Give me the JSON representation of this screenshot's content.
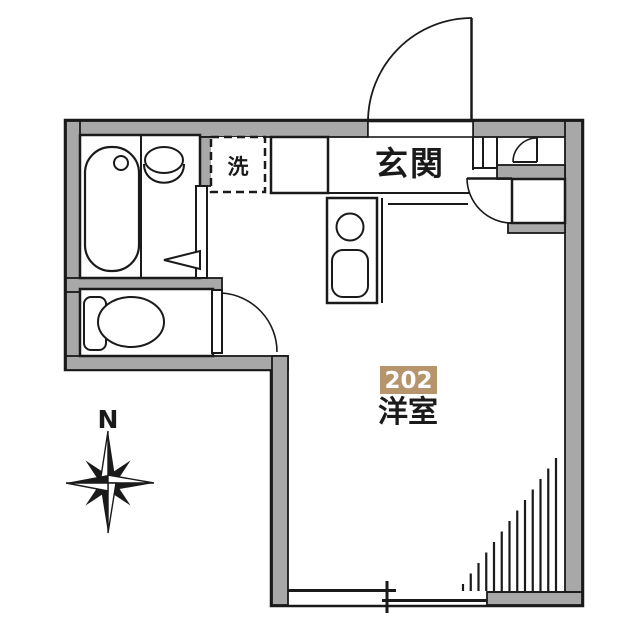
{
  "plan": {
    "labels": {
      "entrance": "玄関",
      "laundry": "洗",
      "room_number": "202",
      "room_name": "洋室",
      "compass_north": "N"
    },
    "colors": {
      "wall_gray": "#a8a8a8",
      "line_black": "#1a1a1a",
      "badge_background": "#b6946c",
      "badge_text": "#ffffff",
      "floor_white": "#ffffff"
    },
    "fixtures": [
      "bathtub",
      "bath-faucet",
      "washbasin",
      "toilet",
      "toilet-tank",
      "washing-machine-space",
      "kitchen-counter",
      "stove-burner",
      "kitchen-sink",
      "entrance-door",
      "closet-door",
      "cabinet-door",
      "toilet-door",
      "sliding-window",
      "exterior-stairs",
      "compass-rose"
    ]
  }
}
